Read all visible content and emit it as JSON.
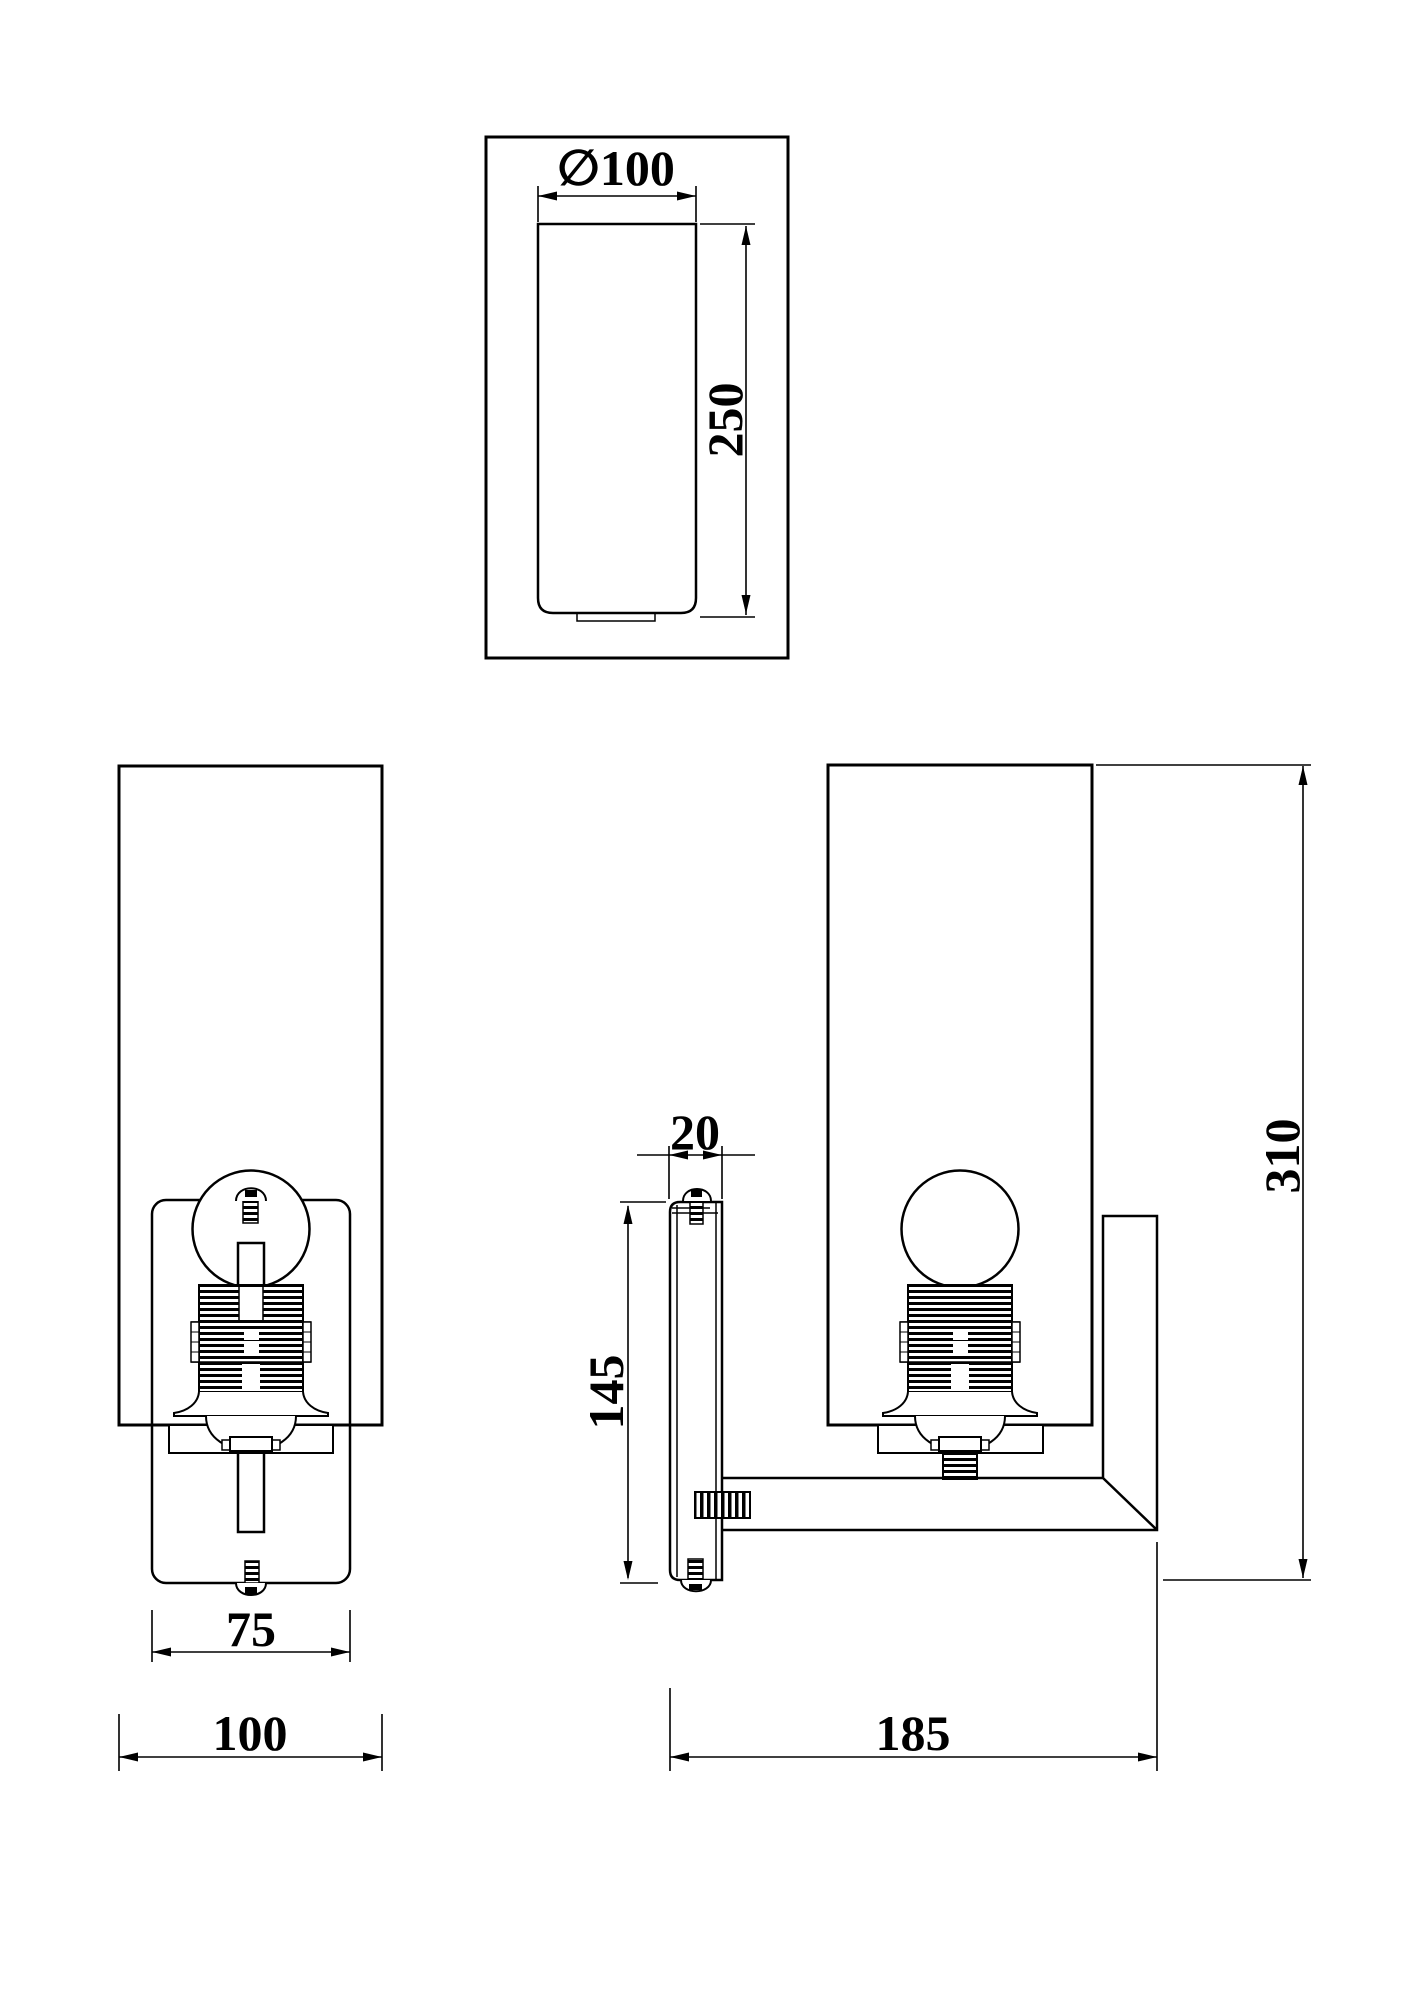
{
  "page": {
    "background": "#ffffff",
    "line_color": "#000000"
  },
  "views": {
    "top_view": {
      "diameter": "∅100",
      "shade_height": "250"
    },
    "front_view": {
      "backplate_width": "75",
      "shade_width": "100"
    },
    "side_view": {
      "plate_depth": "20",
      "plate_height": "145",
      "total_depth": "185",
      "total_height": "310"
    }
  }
}
